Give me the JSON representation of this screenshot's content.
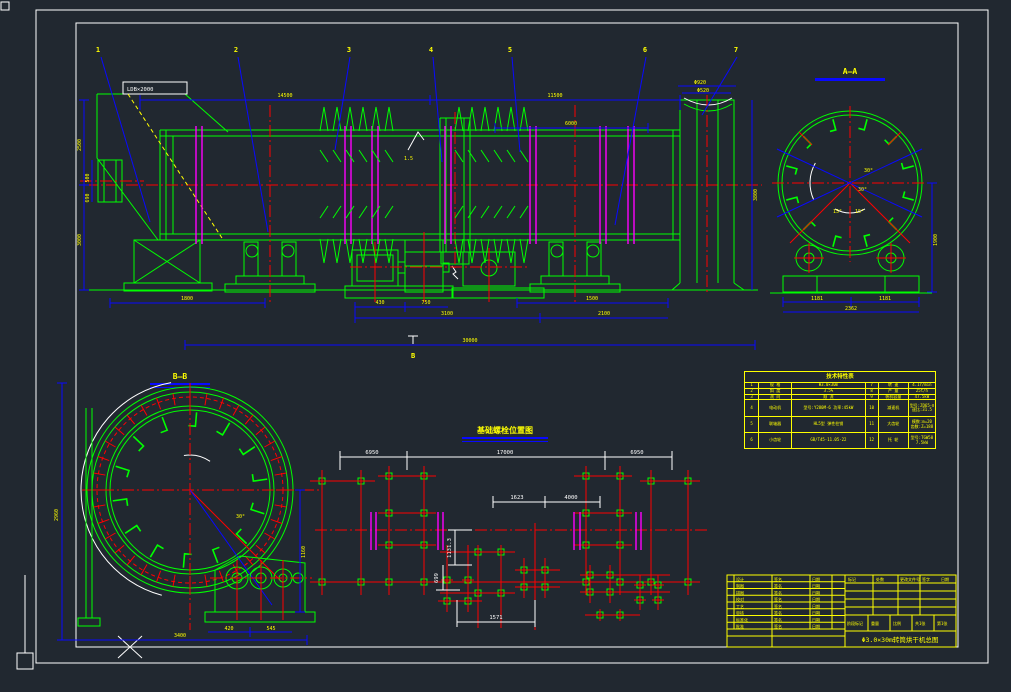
{
  "colors": {
    "background": "#212830",
    "green": "#00ff00",
    "red": "#ff0000",
    "blue": "#0909ff",
    "yellow": "#ffff00",
    "magenta": "#ff00ff",
    "white": "#ffffff"
  },
  "callouts": {
    "c1": "1",
    "c2": "2",
    "c3": "3",
    "c4": "4",
    "c5": "5",
    "c6": "6",
    "c7": "7"
  },
  "sections": {
    "aa": "A—A",
    "bb": "B—B",
    "cut_mark": "B"
  },
  "annotations": {
    "hopper_tag": "LDB×2000",
    "slope": "1.5",
    "angle30": "30°",
    "angle15": "15°"
  },
  "dims": {
    "top1": "14500",
    "top2": "11500",
    "top3": "6000",
    "left1": "2500",
    "left2": "3000",
    "feed1": "500",
    "feed2": "690",
    "hood_d1": "Φ920",
    "hood_d2": "Φ520",
    "right_v": "3800",
    "bot1": "1800",
    "bot2": "430",
    "bot3": "750",
    "bot4": "3100",
    "bot5": "2100",
    "bot6": "1500",
    "overall": "30000",
    "aa_left": "1181",
    "aa_right_seg": "1181",
    "aa_total": "2362",
    "aa_height": "1900",
    "bb_left": "2960",
    "bb_bottom": "3400",
    "bb_right": "1160",
    "bb_gb1": "420",
    "bb_gb2": "545"
  },
  "foundation": {
    "title": "基础螺栓位置图",
    "span_left": "6950",
    "span_mid": "17000",
    "span_right": "6950",
    "d1": "1623",
    "d2": "4000",
    "v1": "1131.3",
    "v2": "699",
    "bottom": "1571"
  },
  "spec_table": {
    "title": "技术特性表",
    "rows": [
      [
        "1",
        "规 格",
        "Φ3.0×30m",
        "7",
        "转 速",
        "4.1r/min"
      ],
      [
        "2",
        "斜 度",
        "3.5%",
        "8",
        "产 量",
        "25t/h"
      ],
      [
        "3",
        "流 向",
        "顺 流",
        "9",
        "装机容量",
        "47.5kW"
      ],
      [
        "4",
        "电动机",
        "型号:Y280M-6 功率:45kW",
        "10",
        "减速机",
        "型号:ZQ65-Ⅱ 速比:31.5"
      ],
      [
        "5",
        "联轴器",
        "HL5型 弹性柱销",
        "11",
        "大齿轮",
        "模数:m=20 齿数:Z=188"
      ],
      [
        "6",
        "小齿轮",
        "GB/T45-11.05-22",
        "12",
        "托 轮",
        "型号:TGW50 7.5kW"
      ]
    ]
  },
  "title_block": {
    "rows": [
      [
        "设计",
        "签名",
        "日期"
      ],
      [
        "制图",
        "签名",
        "日期"
      ],
      [
        "描图",
        "签名",
        "日期"
      ],
      [
        "校对",
        "签名",
        "日期"
      ],
      [
        "工艺",
        "签名",
        "日期"
      ],
      [
        "审核",
        "签名",
        "日期"
      ],
      [
        "标准化",
        "签名",
        "日期"
      ],
      [
        "批准",
        "签名",
        "日期"
      ]
    ],
    "header_cells": [
      "标记",
      "处数",
      "更改文件号",
      "签字",
      "日期"
    ],
    "info_cells": [
      "阶段标记",
      "重量",
      "比例",
      "共1张",
      "第1张"
    ],
    "title": "Φ3.0×30m转筒烘干机总图"
  }
}
